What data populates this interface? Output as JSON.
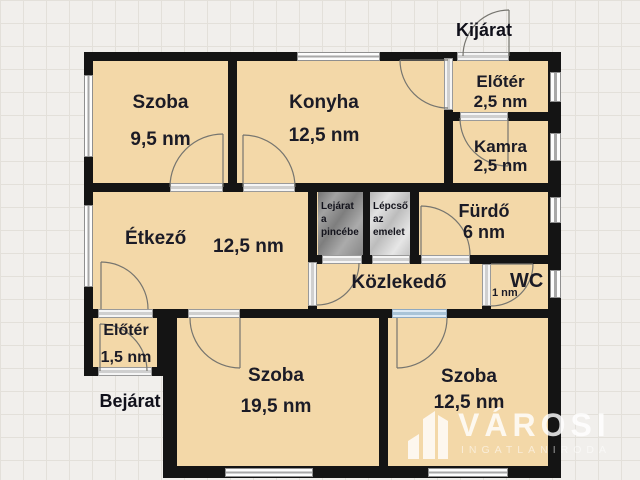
{
  "plan": {
    "rooms": {
      "szoba_topleft": {
        "name": "Szoba",
        "area": "9,5 nm"
      },
      "konyha": {
        "name": "Konyha",
        "area": "12,5 nm"
      },
      "eloter_top": {
        "name": "Előtér",
        "area": "2,5 nm"
      },
      "kamra": {
        "name": "Kamra",
        "area": "2,5 nm"
      },
      "etkezo": {
        "name": "Étkező",
        "area": "12,5 nm"
      },
      "furdo": {
        "name": "Fürdő",
        "area": "6 nm"
      },
      "wc": {
        "name": "WC",
        "area": "1 nm"
      },
      "kozlekedo": {
        "name": "Közlekedő"
      },
      "eloter_bottom": {
        "name": "Előtér",
        "area": "1,5 nm"
      },
      "szoba_bottomleft": {
        "name": "Szoba",
        "area": "19,5 nm"
      },
      "szoba_bottomright": {
        "name": "Szoba",
        "area": "12,5 nm"
      }
    },
    "stairs": {
      "basement": {
        "line1": "Lejárat",
        "line2": "a",
        "line3": "pincébe"
      },
      "upper": {
        "line1": "Lépcső",
        "line2": "az",
        "line3": "emelet"
      }
    },
    "labels": {
      "exit": "Kijárat",
      "entrance": "Bejárat"
    }
  },
  "watermark": {
    "brand": "VÁROSI",
    "subtitle": "INGATLANIRODA"
  },
  "colors": {
    "wall": "#141414",
    "floor": "#f3d8a8",
    "background": "#f1efec",
    "grid_line": "#e3e0da",
    "window": "#fdfdfd",
    "door_highlight": "#a9c4d8",
    "label_text": "#1b1b26",
    "watermark": "#ffffff"
  }
}
